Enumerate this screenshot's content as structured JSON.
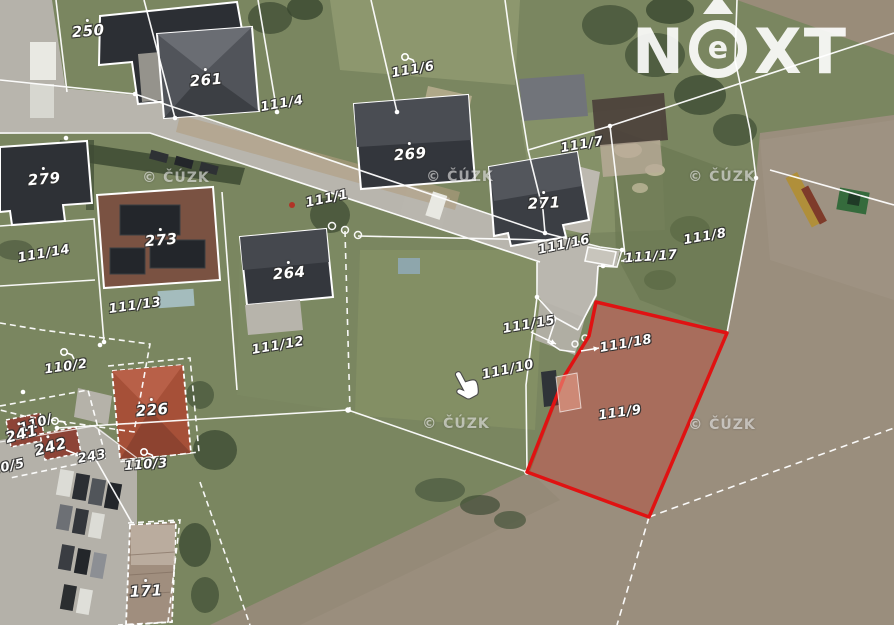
{
  "brand": {
    "name": "NEXT",
    "letters": {
      "n": "N",
      "e": "e",
      "x": "X",
      "t": "T"
    }
  },
  "colors": {
    "highlight_red": "#e01212",
    "highlight_fill": "rgba(200,40,25,0.32)",
    "label_white": "#ffffff",
    "logo_white": "rgba(255,255,255,0.9)",
    "watermark_white": "rgba(255,255,255,0.55)"
  },
  "map": {
    "watermark": {
      "text": "© ČÚZK",
      "positions": [
        {
          "x": 176,
          "y": 178
        },
        {
          "x": 460,
          "y": 177
        },
        {
          "x": 722,
          "y": 177
        },
        {
          "x": 456,
          "y": 424
        },
        {
          "x": 722,
          "y": 425
        }
      ]
    },
    "cursor": {
      "x": 452,
      "y": 368
    },
    "highlight": {
      "parcel": "111/9",
      "outline": "#e01212",
      "fill": "rgba(200,40,25,0.32)",
      "points": "596,302 727,333 649,517 527,472 565,375 589,336"
    },
    "labels": [
      {
        "text": "250",
        "x": 88,
        "y": 29,
        "rot": -5,
        "kind": "house"
      },
      {
        "text": "261",
        "x": 206,
        "y": 78,
        "rot": -5,
        "kind": "house"
      },
      {
        "text": "111/4",
        "x": 282,
        "y": 104,
        "rot": -10,
        "kind": "parcel"
      },
      {
        "text": "111/6",
        "x": 413,
        "y": 70,
        "rot": -10,
        "kind": "parcel"
      },
      {
        "text": "269",
        "x": 410,
        "y": 152,
        "rot": -5,
        "kind": "house"
      },
      {
        "text": "111/7",
        "x": 582,
        "y": 145,
        "rot": -10,
        "kind": "parcel"
      },
      {
        "text": "279",
        "x": 44,
        "y": 177,
        "rot": -5,
        "kind": "house"
      },
      {
        "text": "111/1",
        "x": 327,
        "y": 199,
        "rot": -12,
        "kind": "parcel"
      },
      {
        "text": "271",
        "x": 544,
        "y": 201,
        "rot": -3,
        "kind": "house"
      },
      {
        "text": "273",
        "x": 161,
        "y": 238,
        "rot": -5,
        "kind": "house"
      },
      {
        "text": "111/14",
        "x": 44,
        "y": 254,
        "rot": -10,
        "kind": "parcel"
      },
      {
        "text": "111/8",
        "x": 705,
        "y": 237,
        "rot": -10,
        "kind": "parcel"
      },
      {
        "text": "111/16",
        "x": 564,
        "y": 245,
        "rot": -12,
        "kind": "parcel"
      },
      {
        "text": "111/17",
        "x": 651,
        "y": 257,
        "rot": -4,
        "kind": "parcel"
      },
      {
        "text": "264",
        "x": 289,
        "y": 271,
        "rot": -5,
        "kind": "house"
      },
      {
        "text": "111/13",
        "x": 135,
        "y": 306,
        "rot": -8,
        "kind": "parcel"
      },
      {
        "text": "111/15",
        "x": 529,
        "y": 325,
        "rot": -10,
        "kind": "parcel"
      },
      {
        "text": "111/12",
        "x": 278,
        "y": 346,
        "rot": -10,
        "kind": "parcel"
      },
      {
        "text": "111/18",
        "x": 626,
        "y": 344,
        "rot": -10,
        "kind": "parcel"
      },
      {
        "text": "110/2",
        "x": 66,
        "y": 367,
        "rot": -8,
        "kind": "parcel"
      },
      {
        "text": "111/10",
        "x": 508,
        "y": 370,
        "rot": -12,
        "kind": "parcel"
      },
      {
        "text": "226",
        "x": 152,
        "y": 408,
        "rot": -5,
        "kind": "house"
      },
      {
        "text": "111/9",
        "x": 620,
        "y": 413,
        "rot": -8,
        "kind": "parcel"
      },
      {
        "text": "110/",
        "x": 36,
        "y": 424,
        "rot": -18,
        "kind": "parcel"
      },
      {
        "text": "241",
        "x": 21,
        "y": 432,
        "rot": -15,
        "kind": "house"
      },
      {
        "text": "242",
        "x": 50,
        "y": 445,
        "rot": -15,
        "kind": "house"
      },
      {
        "text": "243",
        "x": 92,
        "y": 457,
        "rot": -10,
        "kind": "parcel"
      },
      {
        "text": "110/3",
        "x": 146,
        "y": 465,
        "rot": -4,
        "kind": "parcel"
      },
      {
        "text": "10/5",
        "x": 8,
        "y": 467,
        "rot": -12,
        "kind": "parcel"
      },
      {
        "text": "171",
        "x": 146,
        "y": 589,
        "rot": -3,
        "kind": "house"
      }
    ],
    "symbols": [
      {
        "type": "landuse-key",
        "x": 405,
        "y": 57,
        "rot": 0
      },
      {
        "type": "landuse-key",
        "x": 64,
        "y": 352,
        "rot": 0
      },
      {
        "type": "landuse-key",
        "x": 144,
        "y": 452,
        "rot": 0
      },
      {
        "type": "landuse-key",
        "x": 55,
        "y": 421,
        "rot": -15
      }
    ],
    "arrows": [
      {
        "x1": 646,
        "y1": 259,
        "x2": 621,
        "y2": 261
      },
      {
        "x1": 531,
        "y1": 332,
        "x2": 556,
        "y2": 344
      },
      {
        "x1": 581,
        "y1": 351,
        "x2": 599,
        "y2": 348
      },
      {
        "x1": 66,
        "y1": 450,
        "x2": 81,
        "y2": 456
      }
    ]
  }
}
